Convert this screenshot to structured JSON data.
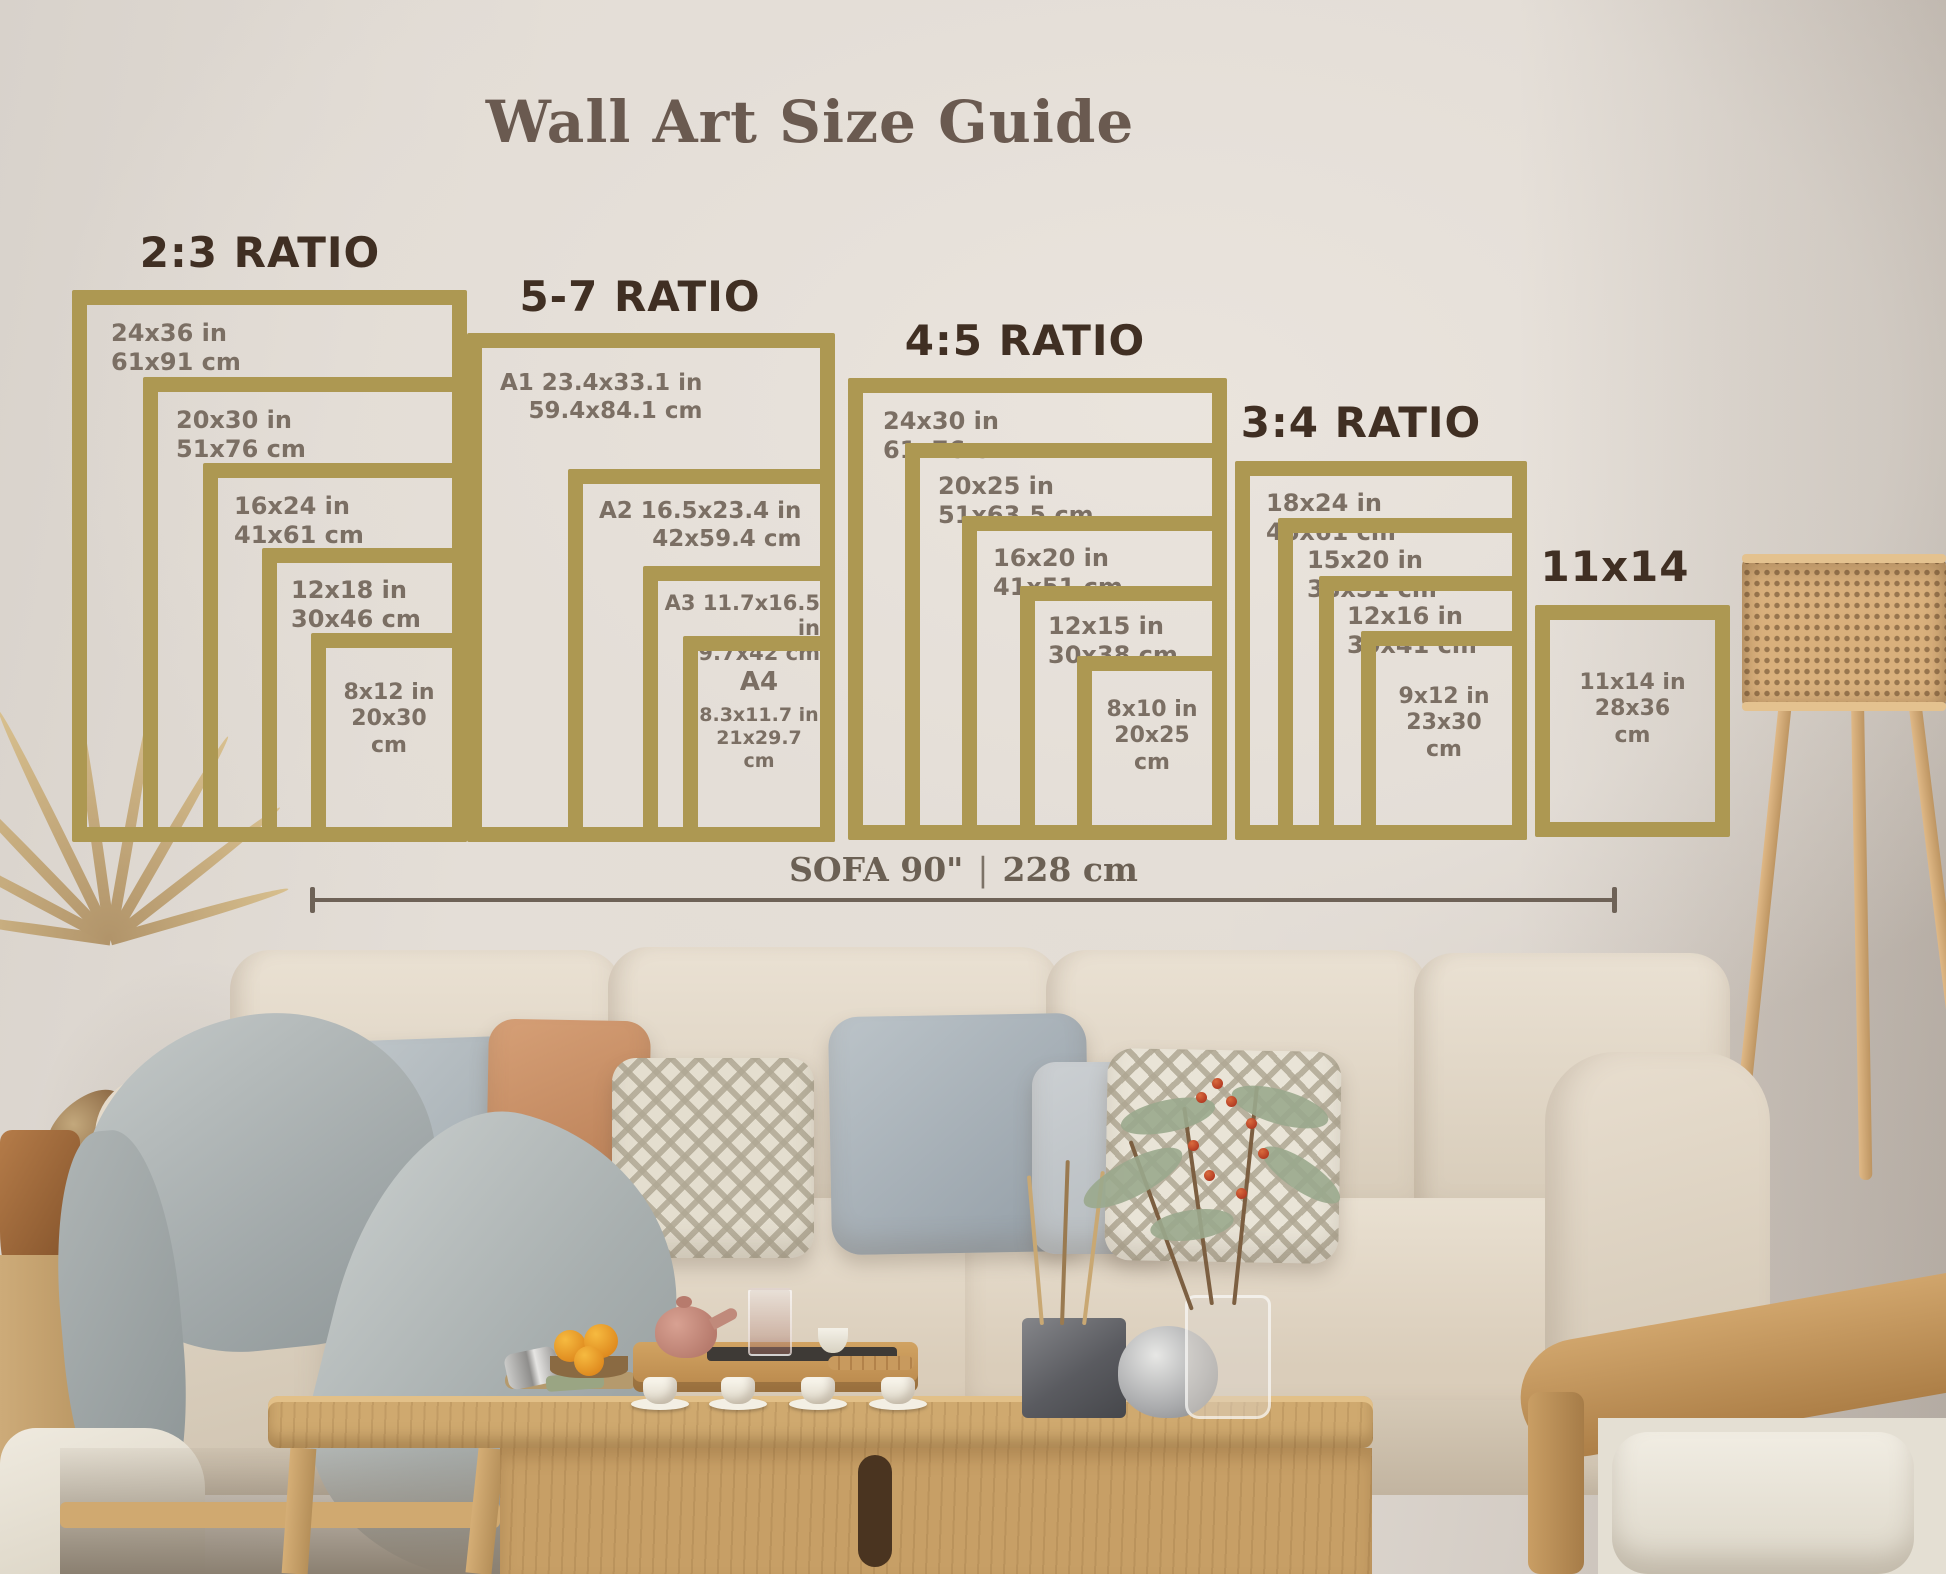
{
  "title": "Wall Art Size Guide",
  "groups": [
    {
      "title": "2:3 RATIO",
      "frames": [
        {
          "lines": [
            "24x36 in",
            "61x91 cm"
          ]
        },
        {
          "lines": [
            "20x30 in",
            "51x76 cm"
          ]
        },
        {
          "lines": [
            "16x24 in",
            "41x61 cm"
          ]
        },
        {
          "lines": [
            "12x18 in",
            "30x46 cm"
          ]
        },
        {
          "lines": [
            "8x12 in",
            "20x30",
            "cm"
          ]
        }
      ]
    },
    {
      "title": "5-7 RATIO",
      "frames": [
        {
          "lines": [
            "A1 23.4x33.1 in",
            "59.4x84.1 cm"
          ]
        },
        {
          "lines": [
            "A2 16.5x23.4 in",
            "42x59.4 cm"
          ]
        },
        {
          "lines": [
            "A3 11.7x16.5 in",
            "29.7x42 cm"
          ]
        },
        {
          "lines": [
            "A4",
            "8.3x11.7 in",
            "21x29.7",
            "cm"
          ]
        }
      ]
    },
    {
      "title": "4:5 RATIO",
      "frames": [
        {
          "lines": [
            "24x30 in",
            "61x76 cm"
          ]
        },
        {
          "lines": [
            "20x25 in",
            "51x63.5 cm"
          ]
        },
        {
          "lines": [
            "16x20 in",
            "41x51 cm"
          ]
        },
        {
          "lines": [
            "12x15 in",
            "30x38 cm"
          ]
        },
        {
          "lines": [
            "8x10 in",
            "20x25",
            "cm"
          ]
        }
      ]
    },
    {
      "title": "3:4 RATIO",
      "frames": [
        {
          "lines": [
            "18x24 in",
            "46x61 cm"
          ]
        },
        {
          "lines": [
            "15x20 in",
            "38x51 cm"
          ]
        },
        {
          "lines": [
            "12x16 in",
            "30x41 cm"
          ]
        },
        {
          "lines": [
            "9x12 in",
            "23x30",
            "cm"
          ]
        }
      ]
    },
    {
      "title": "11x14",
      "frames": [
        {
          "lines": [
            "11x14 in",
            "28x36",
            "cm"
          ]
        }
      ]
    }
  ],
  "measure": {
    "label": "SOFA 90\"",
    "divider": "|",
    "metric": "228 cm"
  },
  "colors": {
    "frame_gold": "#ad9852",
    "group_title_brown": "#402f23",
    "label_gray_brown": "#7b6f64",
    "main_title_brown": "#6a5a50",
    "measure_brown": "#6e6257"
  }
}
